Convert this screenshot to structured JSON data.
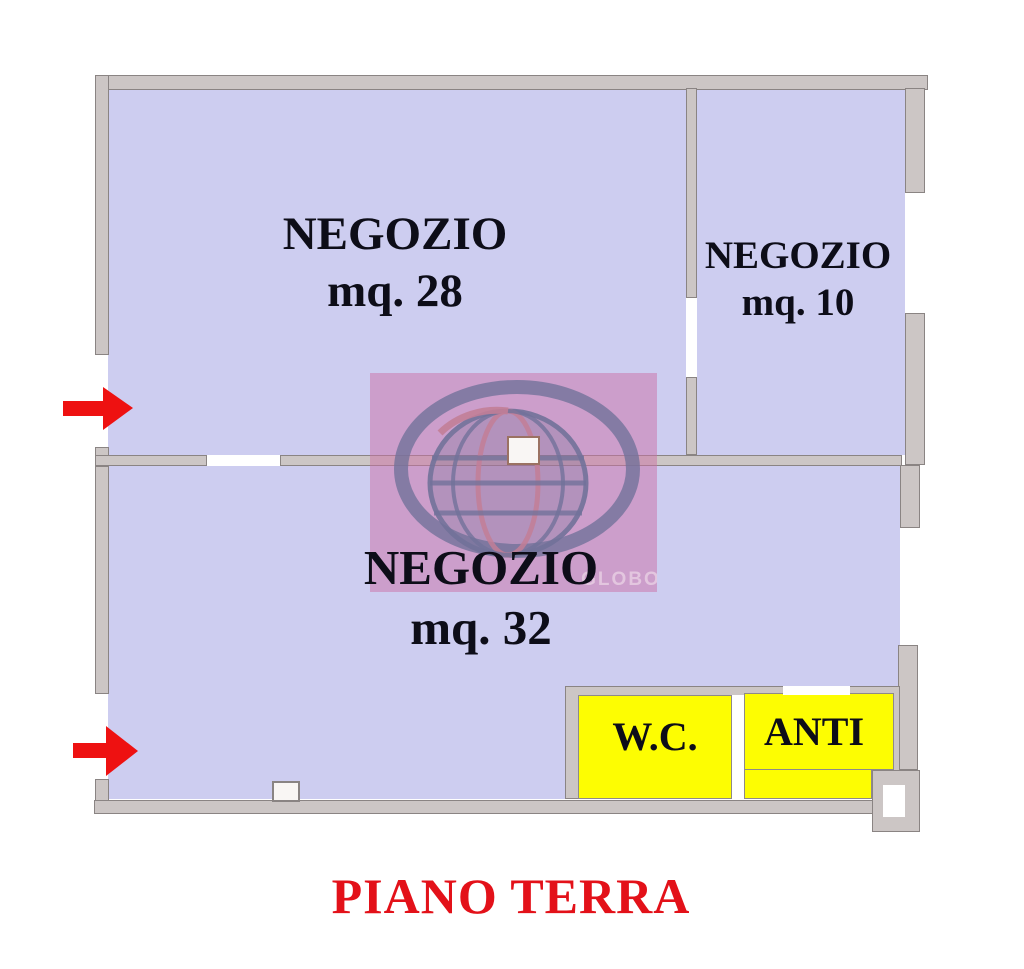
{
  "title": {
    "text": "PIANO TERRA"
  },
  "rooms": {
    "negozio28": {
      "name": "NEGOZIO",
      "area": "mq. 28"
    },
    "negozio10": {
      "name": "NEGOZIO",
      "area": "mq. 10"
    },
    "negozio32": {
      "name": "NEGOZIO",
      "area": "mq. 32"
    },
    "wc": {
      "name": "W.C."
    },
    "anti": {
      "name": "ANTI"
    }
  },
  "watermark": {
    "text": "GLOBO"
  },
  "arrows": [
    {
      "name": "entrance-arrow-upper"
    },
    {
      "name": "entrance-arrow-lower"
    }
  ],
  "colors": {
    "room_fill": "#cdcdf0",
    "service_fill": "#fdfd02",
    "wall_fill": "#ccc6c5",
    "wall_edge": "#8a8483",
    "label_text": "#0d0d18",
    "arrow_red": "#ee1111",
    "title_red": "#e31119",
    "watermark_pink": "rgba(203,112,166,0.5)",
    "watermark_ring": "#72729a",
    "watermark_accent": "#c27e97",
    "watermark_text": "#e3c6df",
    "door_edge": "#9b7263"
  }
}
